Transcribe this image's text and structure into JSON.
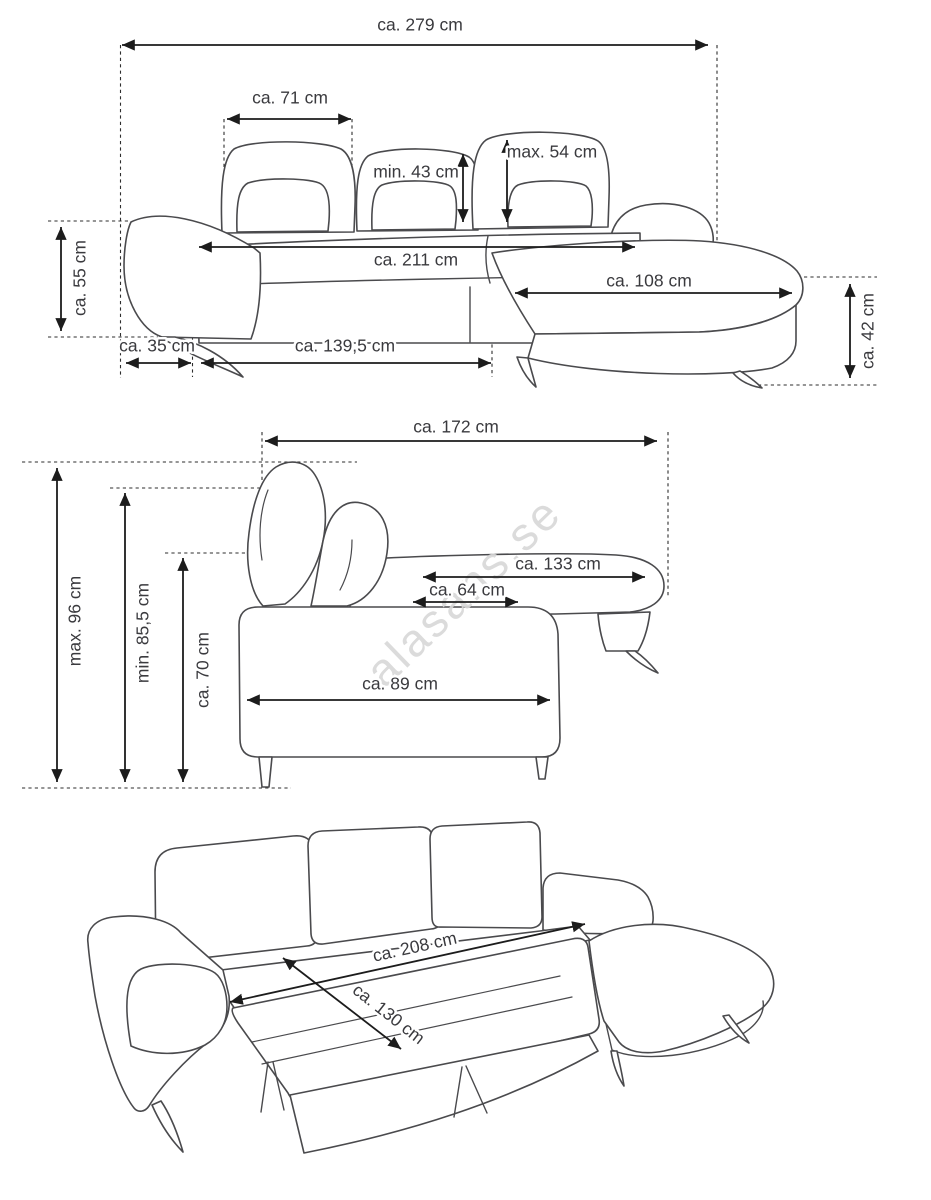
{
  "watermark": "alasans.se",
  "front_view": {
    "overall_width": "ca. 279 cm",
    "cushion_width": "ca. 71 cm",
    "backrest_min": "min. 43 cm",
    "backrest_max": "max. 54 cm",
    "seat_width": "ca. 211 cm",
    "arm_height": "ca. 55 cm",
    "arm_width": "ca. 35 cm",
    "base_width": "ca. 139,5 cm",
    "chaise_length": "ca. 108 cm",
    "seat_height": "ca. 42 cm"
  },
  "side_view": {
    "depth": "ca. 172 cm",
    "height_max": "max. 96 cm",
    "height_min": "min. 85,5 cm",
    "backrest_height": "ca. 70 cm",
    "chaise_depth": "ca. 133 cm",
    "seat_depth": "ca. 64 cm",
    "base_depth": "ca. 89 cm"
  },
  "bed_view": {
    "length": "ca. 208 cm",
    "width": "ca. 130 cm"
  }
}
